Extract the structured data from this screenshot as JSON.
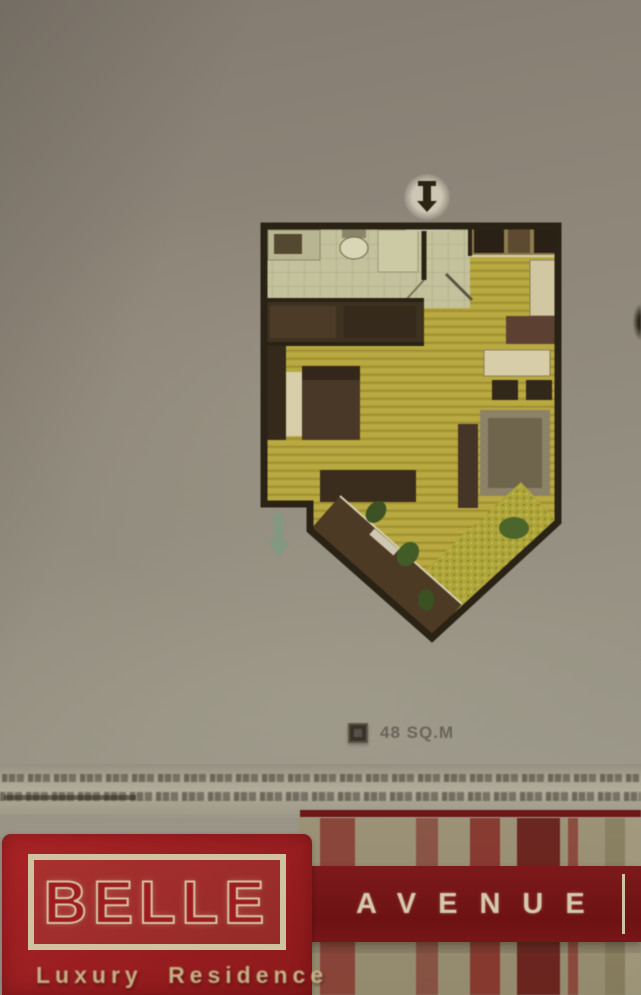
{
  "unit": {
    "area_label": "48 SQ.M"
  },
  "branding": {
    "name": "BELLE",
    "series": "AVENUE",
    "tagline": "Luxury Residence"
  },
  "icons": {
    "area_marker": "filled-square",
    "entrance": "down-arrow",
    "balcony_exit": "down-arrow",
    "page_edge": "dark-chevron-fragment"
  },
  "colors": {
    "paper": "#8f887c",
    "floor_wood": "#baa93c",
    "wall": "#2a2214",
    "bathroom_tile": "#c4c29b",
    "balcony_deck": "#4e3a23",
    "plant_green": "#3b5222",
    "banner_red": "#9c1f21",
    "band_dark_red": "#6d1214",
    "cream": "#d4c7a4"
  }
}
